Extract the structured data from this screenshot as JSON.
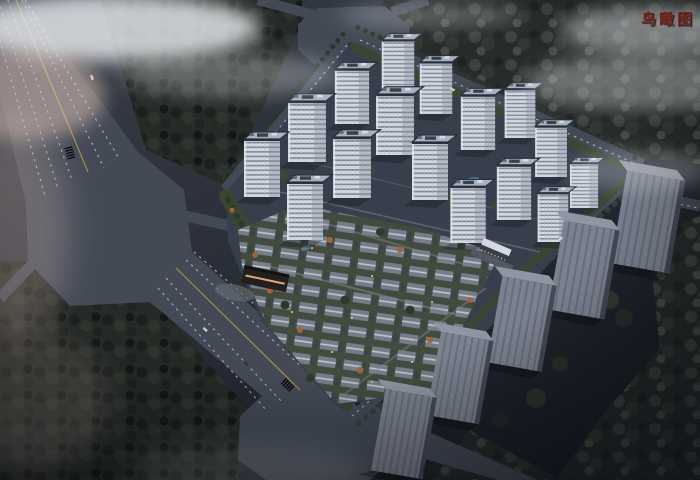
{
  "annotation": {
    "label": "鸟瞰图"
  },
  "palette": {
    "label_red": "#742a21",
    "ground_hi": "#3c414b",
    "ground_lo": "#14161c",
    "road": "#474d59",
    "lane_dash": "#ccd2db",
    "lane_yellow": "#c2a045",
    "forest_base": "#262b25",
    "tree_dark": "#1b201b",
    "tree_lite": "#323a30",
    "forest_grey": "#272b28",
    "tree_grey": "#434a40",
    "site_base": "#3a414d",
    "green_strip": "#3e4833",
    "facade": "#e9edf3",
    "facade_win": "#7d8696",
    "roof_light": "#b7c0cd",
    "roof_trim": "#2a313d",
    "villa_green": "#46503e",
    "villa_roof": "#7e8692",
    "villa_ridge": "#d2d7de",
    "autumn": "#b06a3c",
    "warm_light": "#ffc47d",
    "context_front": "#868c99",
    "context_rib": "#6e7482",
    "context_top": "#9ba1ad",
    "context_side": "#474c57",
    "pool": "#5c87a8",
    "gate_dark": "#221f1b",
    "cloud": "#eef1f4",
    "fog_pink": "#e8c9bd"
  },
  "scene": {
    "view": "dusk aerial bird's-eye architectural rendering",
    "development": {
      "highrise_towers": 16,
      "lowrise_area": "courtyard villa cluster with gardens, autumn trees and pools",
      "gates": 2
    },
    "surroundings": {
      "context_massing_buildings": 5,
      "octagonal_intersections": 3,
      "forest_patches": 4,
      "fog": "white cloud wisps over avenue and woods"
    }
  }
}
